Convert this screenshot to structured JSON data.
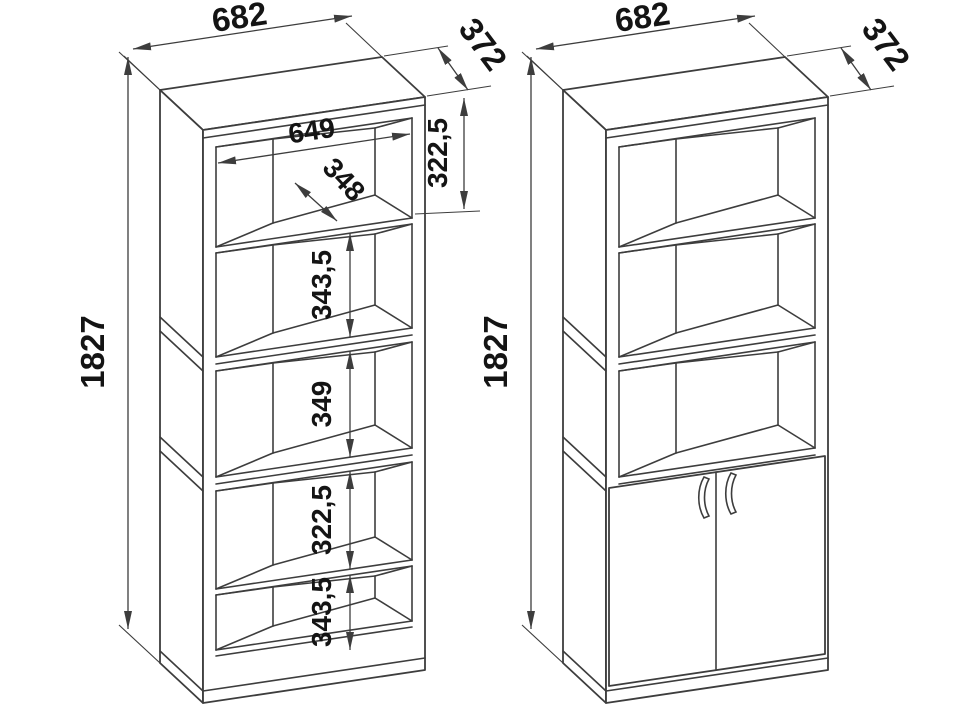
{
  "drawing": {
    "background": "#ffffff",
    "line_color": "#3d3d3d",
    "text_color": "#141414",
    "unit": "mm"
  },
  "left_view": {
    "width_mm": "682",
    "depth_mm": "372",
    "height_mm": "1827",
    "inner_width_mm": "649",
    "shelf_depth_mm": "348",
    "section_1_mm": "322,5",
    "section_2_mm": "343,5",
    "section_3_mm": "349",
    "section_4_mm": "322,5",
    "section_5_mm": "343,5"
  },
  "right_view": {
    "width_mm": "682",
    "depth_mm": "372",
    "height_mm": "1827"
  }
}
